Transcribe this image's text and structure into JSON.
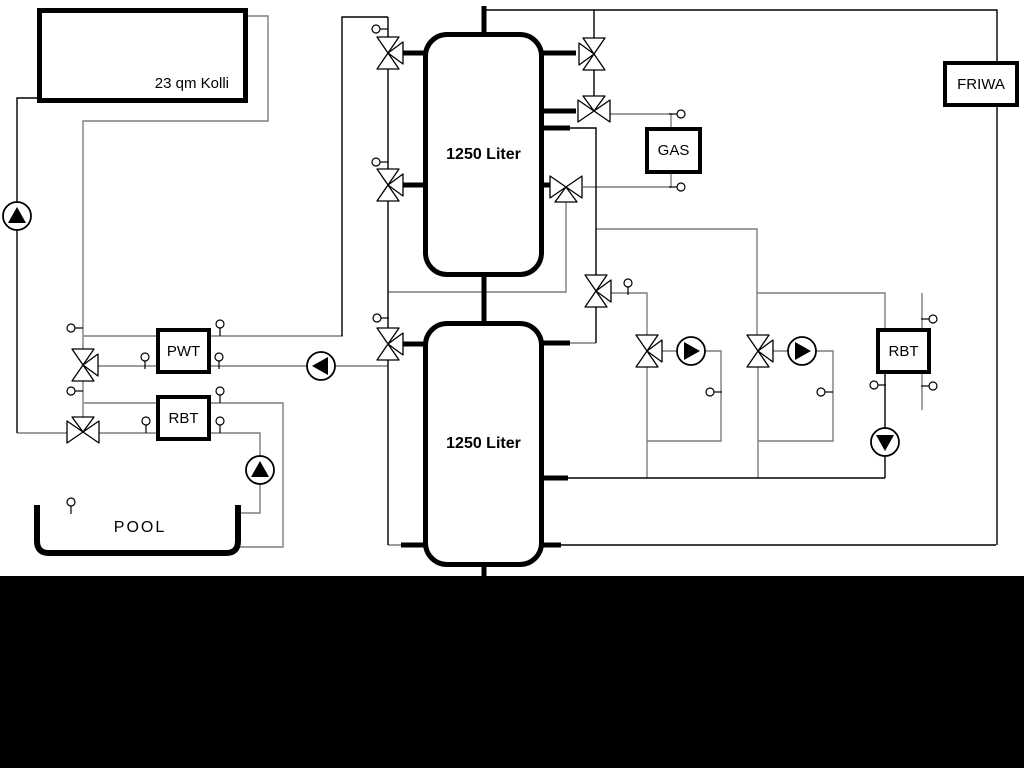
{
  "labels": {
    "collector": "23 qm Kolli",
    "tank_top": "1250 Liter",
    "tank_bottom": "1250 Liter",
    "gas": "GAS",
    "friwa": "FRIWA",
    "pwt": "PWT",
    "rbt_left": "RBT",
    "rbt_right": "RBT",
    "pool": "POOL"
  },
  "colors": {
    "background": "#ffffff",
    "pipe_gray": "#7d7d7d",
    "pipe_black": "#000000",
    "footer_bar": "#000000"
  }
}
